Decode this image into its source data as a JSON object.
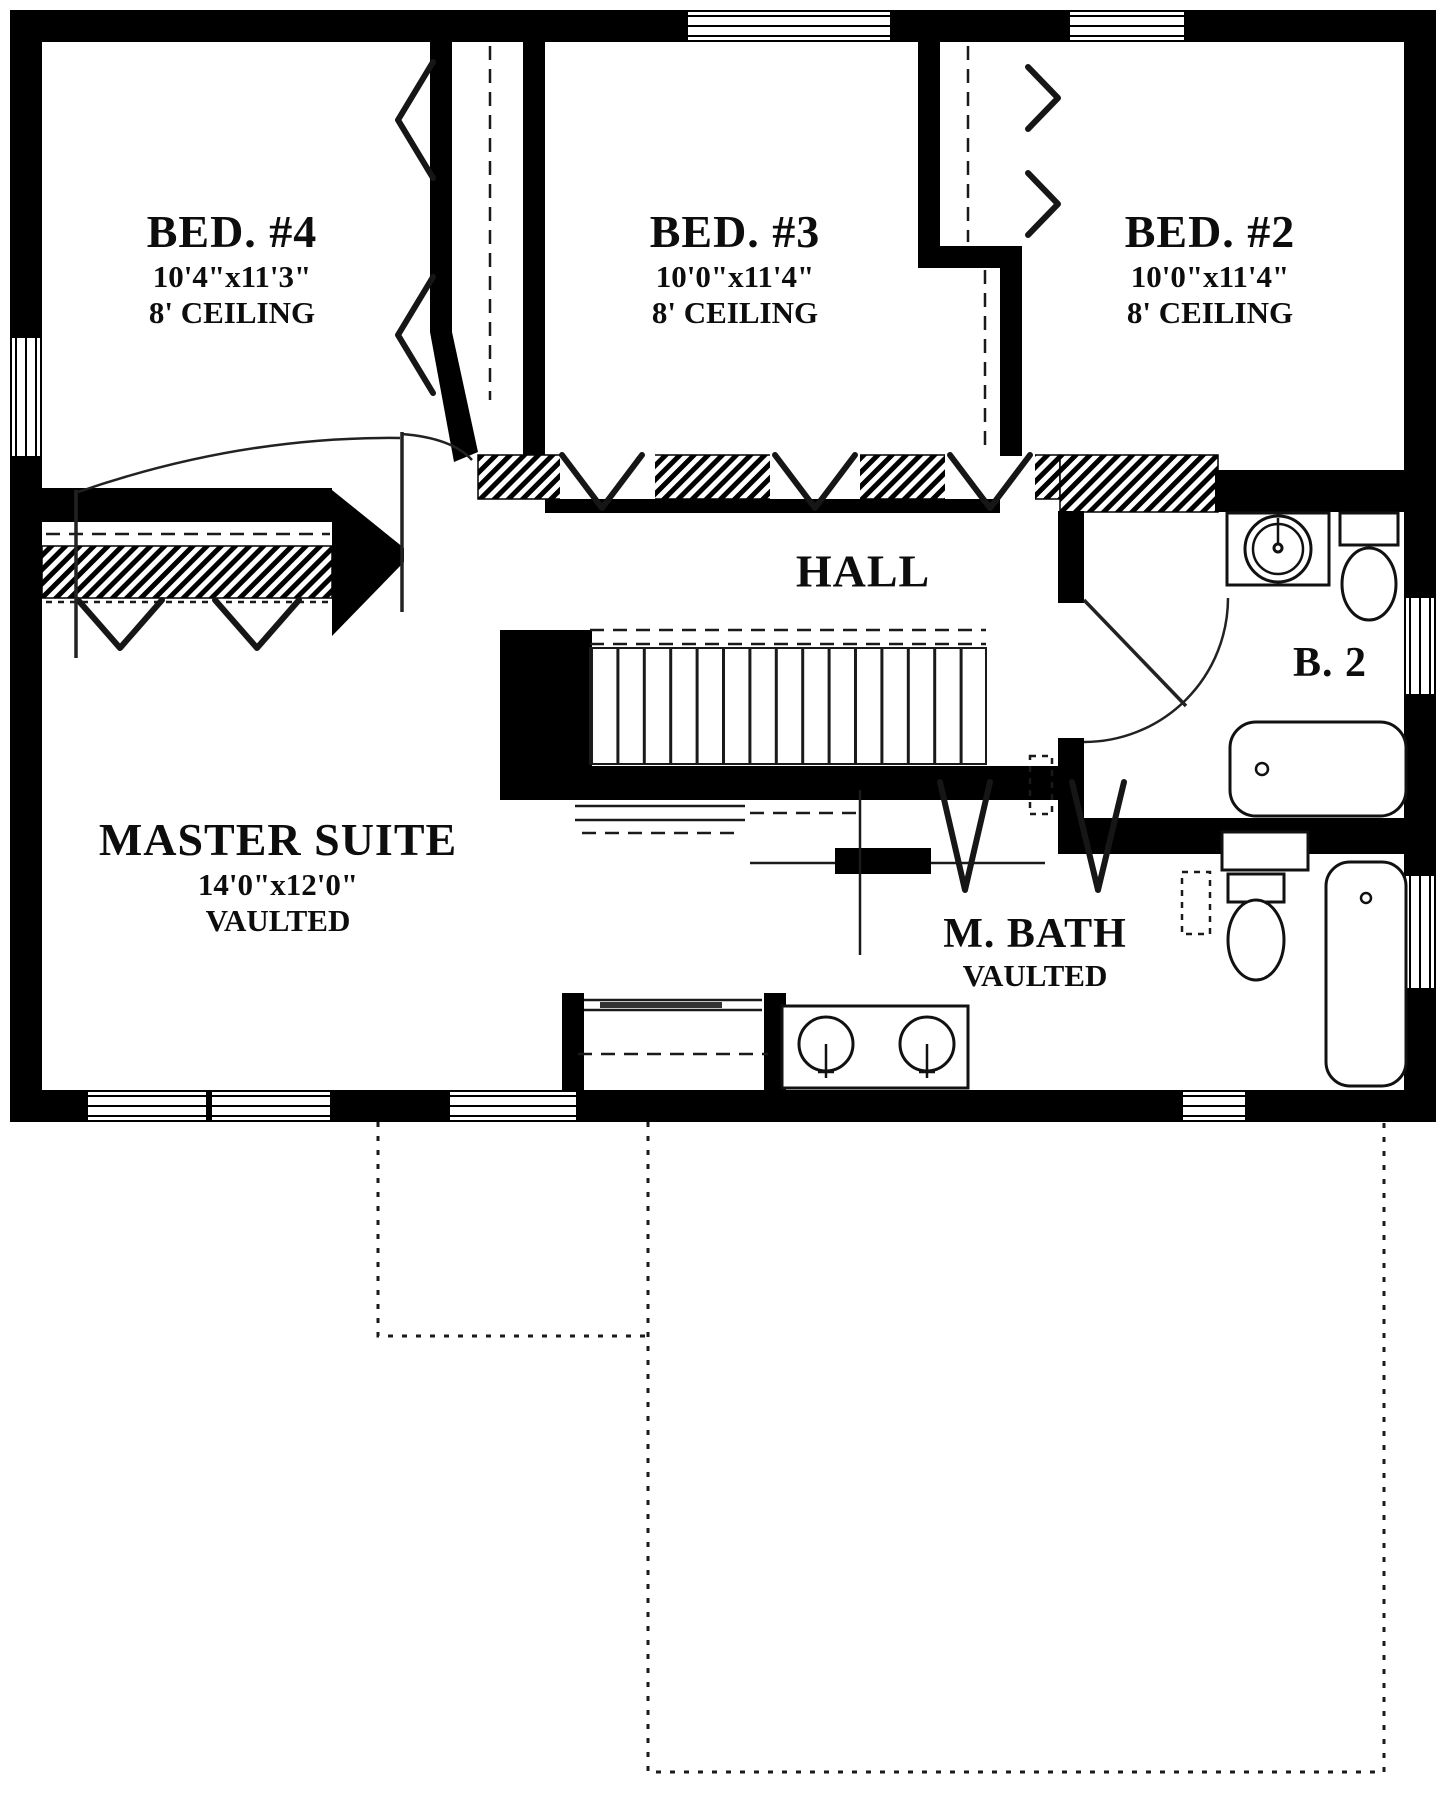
{
  "rooms": {
    "bed4": {
      "name": "BED. #4",
      "dims": "10'4\"x11'3\"",
      "ceiling": "8' CEILING"
    },
    "bed3": {
      "name": "BED. #3",
      "dims": "10'0\"x11'4\"",
      "ceiling": "8' CEILING"
    },
    "bed2": {
      "name": "BED. #2",
      "dims": "10'0\"x11'4\"",
      "ceiling": "8' CEILING"
    },
    "hall": {
      "name": "HALL"
    },
    "bath2": {
      "name": "B. 2"
    },
    "master": {
      "name": "MASTER SUITE",
      "dims": "14'0\"x12'0\"",
      "note": "VAULTED"
    },
    "mbath": {
      "name": "M. BATH",
      "note": "VAULTED"
    }
  },
  "colors": {
    "wall": "#000000",
    "background": "#ffffff"
  }
}
